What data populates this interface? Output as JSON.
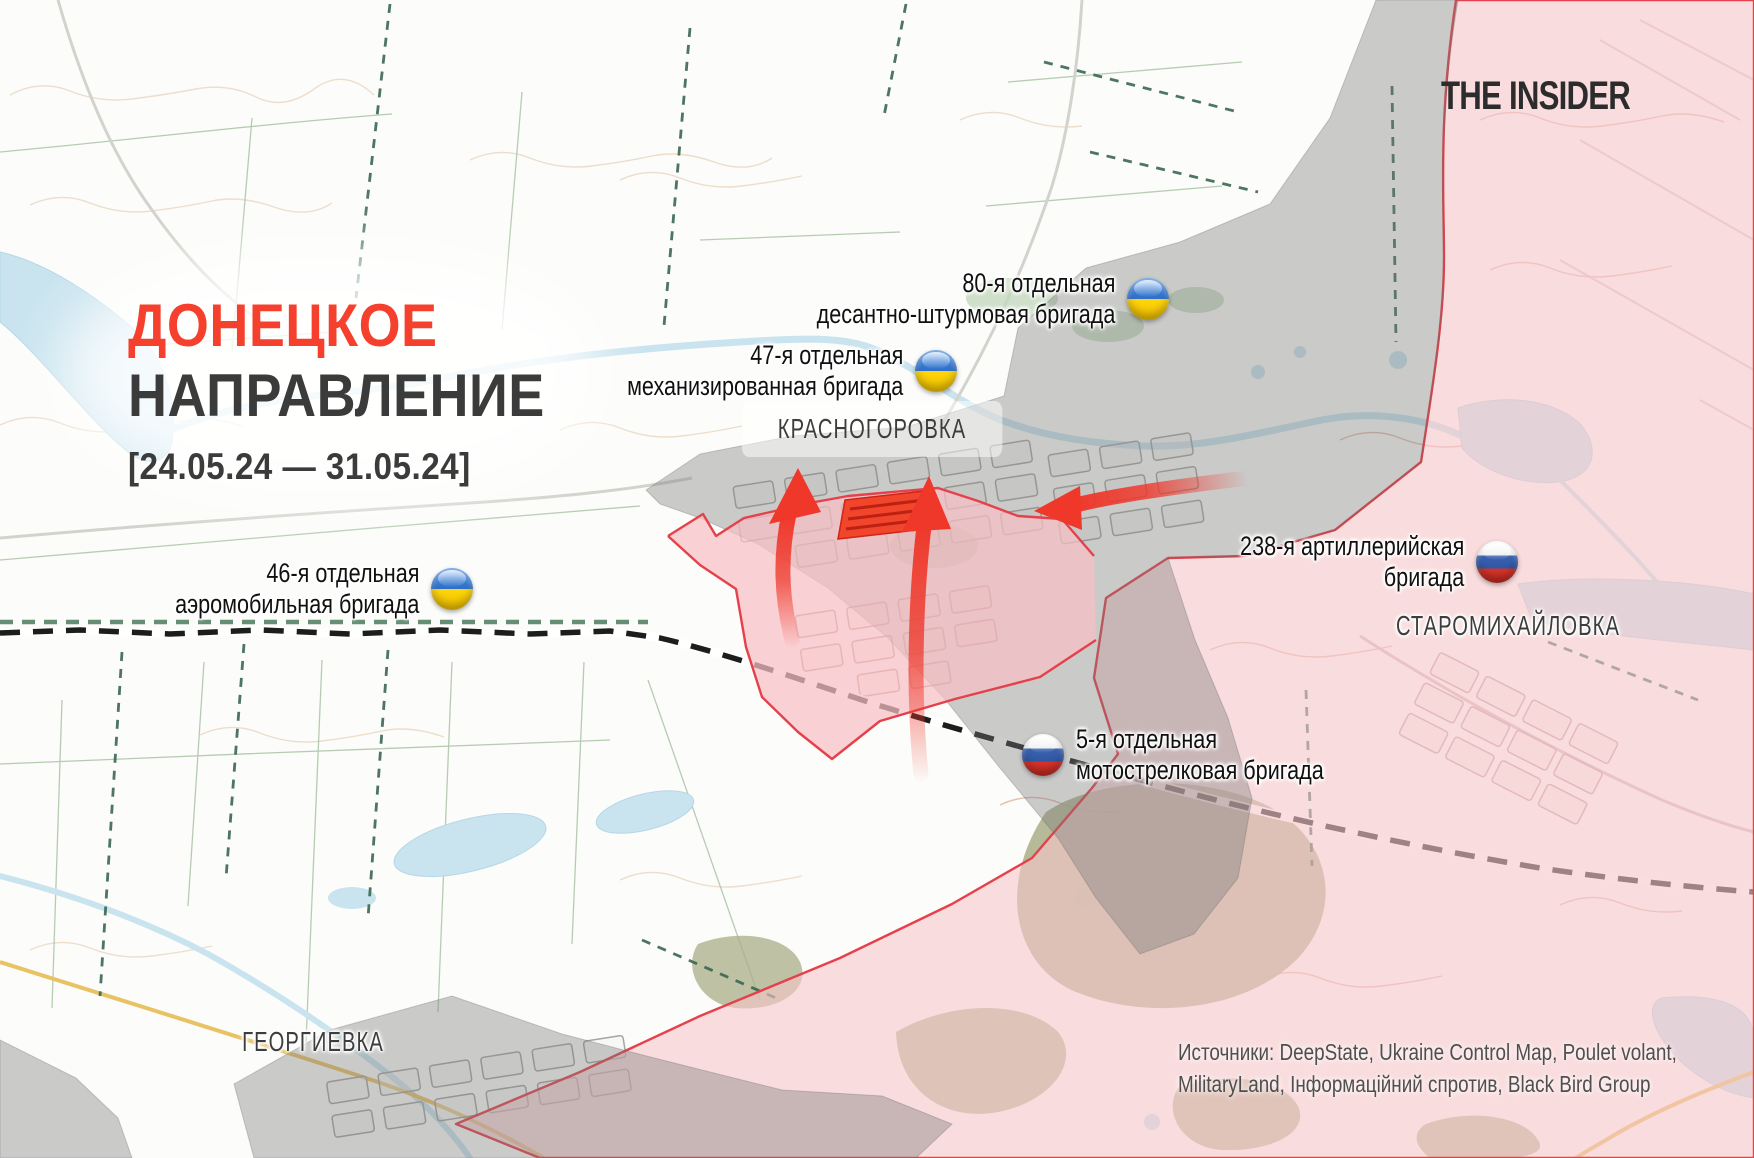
{
  "branding": {
    "logo_text": "THE INSIDER"
  },
  "title": {
    "region": "ДОНЕЦКОЕ",
    "direction": "НАПРАВЛЕНИЕ",
    "date_range": "[24.05.24 — 31.05.24]"
  },
  "towns": {
    "krasnohorivka": "КРАСНОГОРОВКА",
    "staromykhailivka": "СТАРОМИХАЙЛОВКА",
    "heorhiivka": "ГЕОРГИЕВКА"
  },
  "units": [
    {
      "line1": "80-я отдельная",
      "line2": "десантно-штурмовая бригада",
      "country": "ukraine"
    },
    {
      "line1": "47-я отдельная",
      "line2": "механизированная бригада",
      "country": "ukraine"
    },
    {
      "line1": "46-я отдельная",
      "line2": "аэромобильная бригада",
      "country": "ukraine"
    },
    {
      "line1": "238-я артиллерийская",
      "line2": "бригада",
      "country": "russia"
    },
    {
      "line1": "5-я отдельная",
      "line2": "мотострелковая бригада",
      "country": "russia"
    }
  ],
  "sources": {
    "line1": "Источники: DeepState, Ukraine Control Map, Poulet volant,",
    "line2": "MilitaryLand, Інформаційний спротив, Black Bird Group"
  },
  "colors": {
    "accent_red": "#f5402e",
    "frontline_red": "#e4414b",
    "russian_zone_pink": "#f7c4c8",
    "contested_gray": "#8c8c8c",
    "advance_red": "#f1452c",
    "water_blue": "#c9e4ef",
    "ukraine_flag_blue": "#4a90e2",
    "ukraine_flag_yellow": "#ffd60a",
    "russia_flag_blue": "#3a62b0",
    "russia_flag_red": "#d7342c"
  }
}
